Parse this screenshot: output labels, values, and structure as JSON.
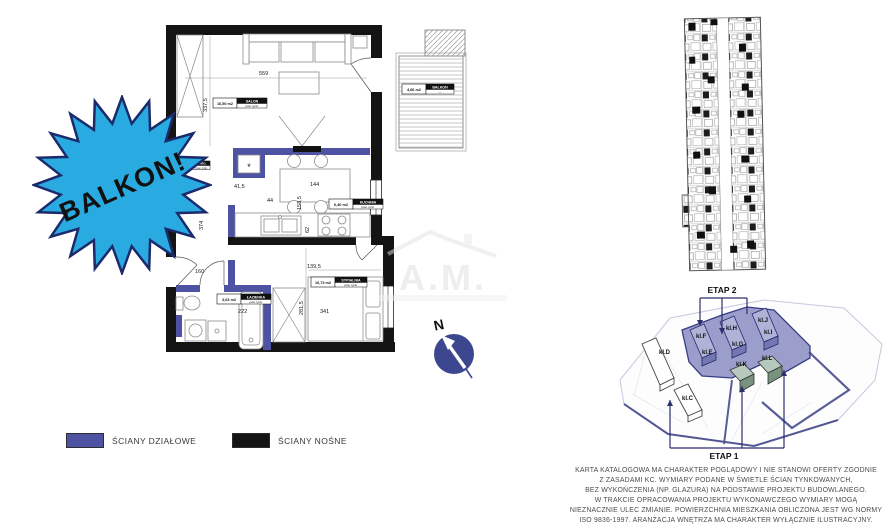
{
  "badge": {
    "label": "BALKON!",
    "fill_color": "#29abe2",
    "outline_color": "#1b2a6b"
  },
  "compass": {
    "north_label": "N",
    "circle_color": "#3d478f"
  },
  "watermark": {
    "logo_text": "A.M."
  },
  "legend": {
    "items": [
      {
        "label": "ŚCIANY DZIAŁOWE",
        "color": "#4d52a3"
      },
      {
        "label": "ŚCIANY NOŚNE",
        "color": "#141414"
      }
    ]
  },
  "floorplan": {
    "rooms": [
      {
        "name": "SALON",
        "area": "16,50 m2",
        "sub": "pow. tynk."
      },
      {
        "name": "KUCHNIA",
        "area": "6,40 m2",
        "sub": "pow. tynk."
      },
      {
        "name": "SYPIALNIA",
        "area": "10,73 m2",
        "sub": "pow. tynk."
      },
      {
        "name": "ŁAZIENKA",
        "area": "3,63 m2",
        "sub": "pow. tynk."
      },
      {
        "name": "BALKON",
        "area": "4,66 m2",
        "sub": "—"
      },
      {
        "name": "GARD.",
        "area": "",
        "sub": "pow. tynk."
      }
    ],
    "dims": [
      "559",
      "337,5",
      "41,5",
      "144",
      "153,5",
      "62",
      "160",
      "374",
      "222",
      "281,5",
      "139,5",
      "341",
      "44"
    ],
    "closet_mark": "*"
  },
  "site_plan": {
    "stage_top": "ETAP 2",
    "stage_bottom": "ETAP 1",
    "buildings": [
      "kl.D",
      "kl.F",
      "kl.E",
      "kl.H",
      "kl.G",
      "kl.J",
      "kl.I",
      "kl.K",
      "kl.L",
      "kl.C"
    ]
  },
  "disclaimer": {
    "lines": [
      "KARTA KATALOGOWA MA CHARAKTER POGLĄDOWY I NIE STANOWI OFERTY ZGODNIE",
      "Z ZASADAMI KC. WYMIARY PODANE W ŚWIETLE ŚCIAN TYNKOWANYCH,",
      "BEZ WYKOŃCZENIA (NP. GLAZURA) NA PODSTAWIE PROJEKTU BUDOWLANEGO.",
      "W TRAKCIE OPRACOWANIA PROJEKTU WYKONAWCZEGO WYMIARY MOGĄ",
      "NIEZNACZNIE ULEC ZMIANIE. POWIERZCHNIA MIESZKANIA OBLICZONA JEST WG NORMY",
      "ISO 9836-1997. ARANŻACJA WNĘTRZA MA CHARAKTER WYŁĄCZNIE ILUSTRACYJNY."
    ]
  }
}
